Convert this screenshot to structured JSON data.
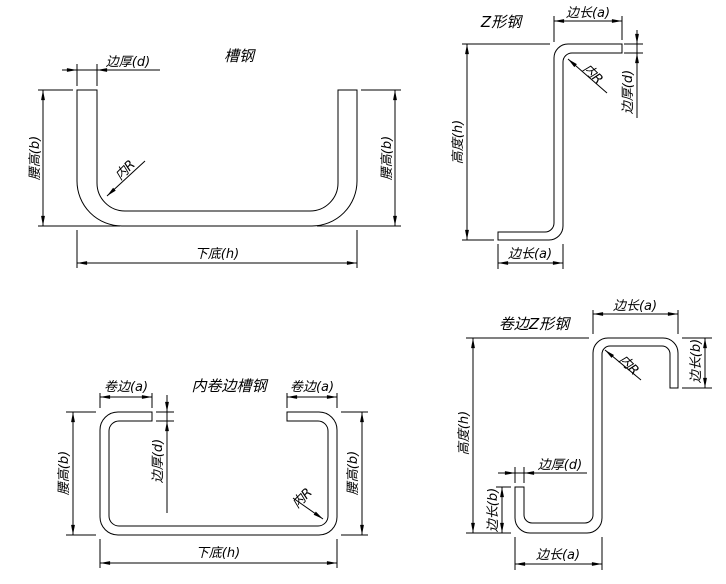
{
  "sheet": {
    "description_colors": {
      "background": "#ffffff",
      "line": "#000000"
    }
  },
  "diagrams": [
    {
      "id": "channel-steel",
      "title": "槽钢",
      "labels": {
        "edge_thickness": "边厚(d)",
        "waist_height_left": "腰高(b)",
        "waist_height_right": "腰高(b)",
        "inner_radius": "内R",
        "bottom_base": "下底(h)"
      }
    },
    {
      "id": "z-shaped-steel",
      "title": "Z形钢",
      "labels": {
        "top_edge_length": "边长(a)",
        "inner_radius": "内R",
        "edge_thickness": "边厚(d)",
        "height": "高度(h)",
        "bottom_edge_length": "边长(a)"
      }
    },
    {
      "id": "inward-lipped-channel-steel",
      "title": "内卷边槽钢",
      "labels": {
        "lip_left": "卷边(a)",
        "lip_right": "卷边(a)",
        "edge_thickness": "边厚(d)",
        "waist_height_left": "腰高(b)",
        "waist_height_right": "腰高(b)",
        "inner_radius": "内R",
        "bottom_base": "下底(h)"
      }
    },
    {
      "id": "lipped-z-shaped-steel",
      "title": "卷边Z形钢",
      "labels": {
        "top_edge_length": "边长(a)",
        "inner_radius": "内R",
        "lip_right": "边长(b)",
        "height": "高度(h)",
        "edge_thickness": "边厚(d)",
        "lip_left": "边长(b)",
        "bottom_edge_length": "边长(a)"
      }
    }
  ]
}
